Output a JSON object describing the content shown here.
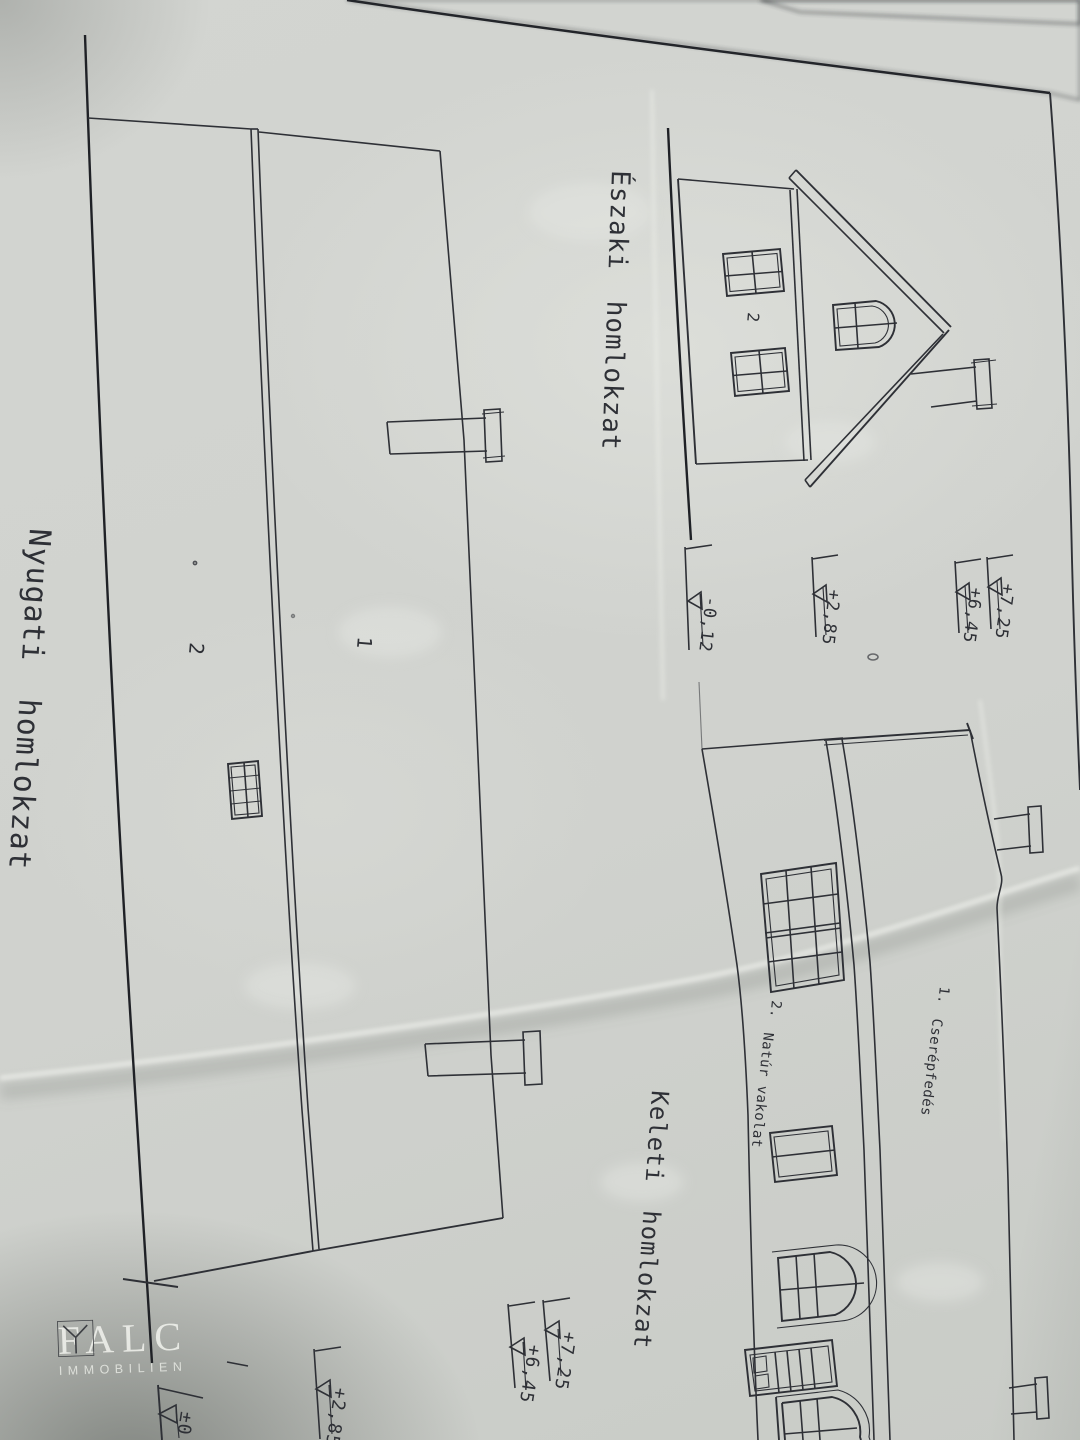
{
  "sheet": {
    "titles": {
      "nyugati": "Nyugati homlokzat",
      "eszaki": "Északi homlokzat",
      "keleti": "Keleti homlokzat"
    },
    "section_labels": {
      "nyugati_section_left": "2",
      "nyugati_section_right": "1",
      "eszaki_wall": "2"
    },
    "levels_middle": {
      "terrain": "-0,12",
      "floor": "+2,85",
      "eave": "+6,45",
      "ridge": "+7,25"
    },
    "levels_bottom": {
      "ground": "±0",
      "floor": "+2,85",
      "eave": "+6,45",
      "ridge": "+7,25"
    },
    "legend": {
      "item1_no": "1.",
      "item1_label": "Cserépfedés",
      "item2_no": "2.",
      "item2_label": "Natúr vakolat"
    }
  },
  "watermark": {
    "brand": "FALC",
    "subtitle": "IMMOBILIEN"
  },
  "colors": {
    "paper": "#d1d3cf",
    "ink": "#2e3036",
    "watermark_text": "#f2f3ee"
  }
}
